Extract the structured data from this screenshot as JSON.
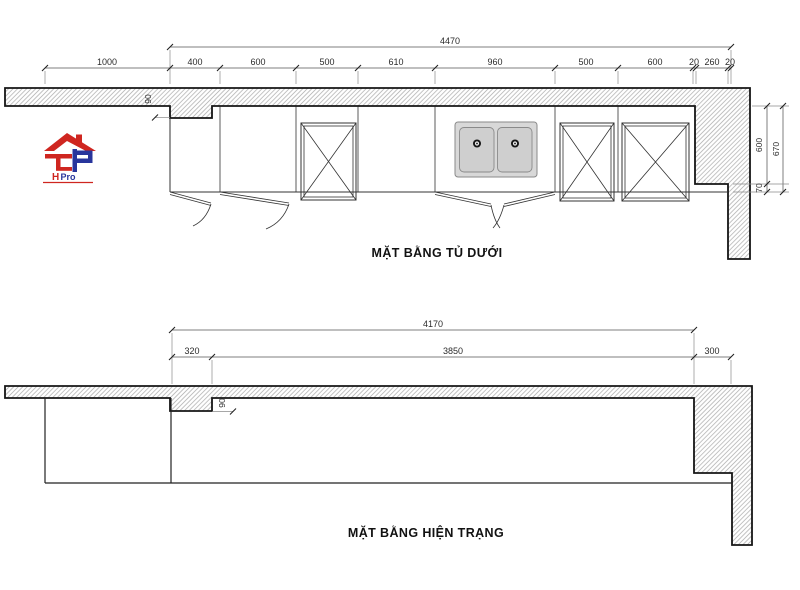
{
  "logo": {
    "brand_h": "H",
    "brand_rest": "Pro",
    "red": "#cf2620",
    "blue": "#28359c"
  },
  "top_plan": {
    "title": "MẶT BẰNG TỦ DƯỚI",
    "total_dim": "4470",
    "segment_dims": [
      "1000",
      "400",
      "600",
      "500",
      "610",
      "960",
      "500",
      "600",
      "20",
      "260",
      "20"
    ],
    "right_dims": {
      "d600": "600",
      "d670": "670",
      "d70": "70"
    },
    "step_dim": "90"
  },
  "bottom_plan": {
    "title": "MẶT BẰNG HIỆN TRẠNG",
    "total_dim": "4170",
    "segment_dims": [
      "320",
      "3850",
      "300"
    ],
    "step_dim": "90"
  },
  "style": {
    "hatch_color": "#a8a8a8",
    "line_color": "#151515",
    "sink_fill": "#d8d8d8",
    "basin_fill": "#cfcfcf"
  }
}
